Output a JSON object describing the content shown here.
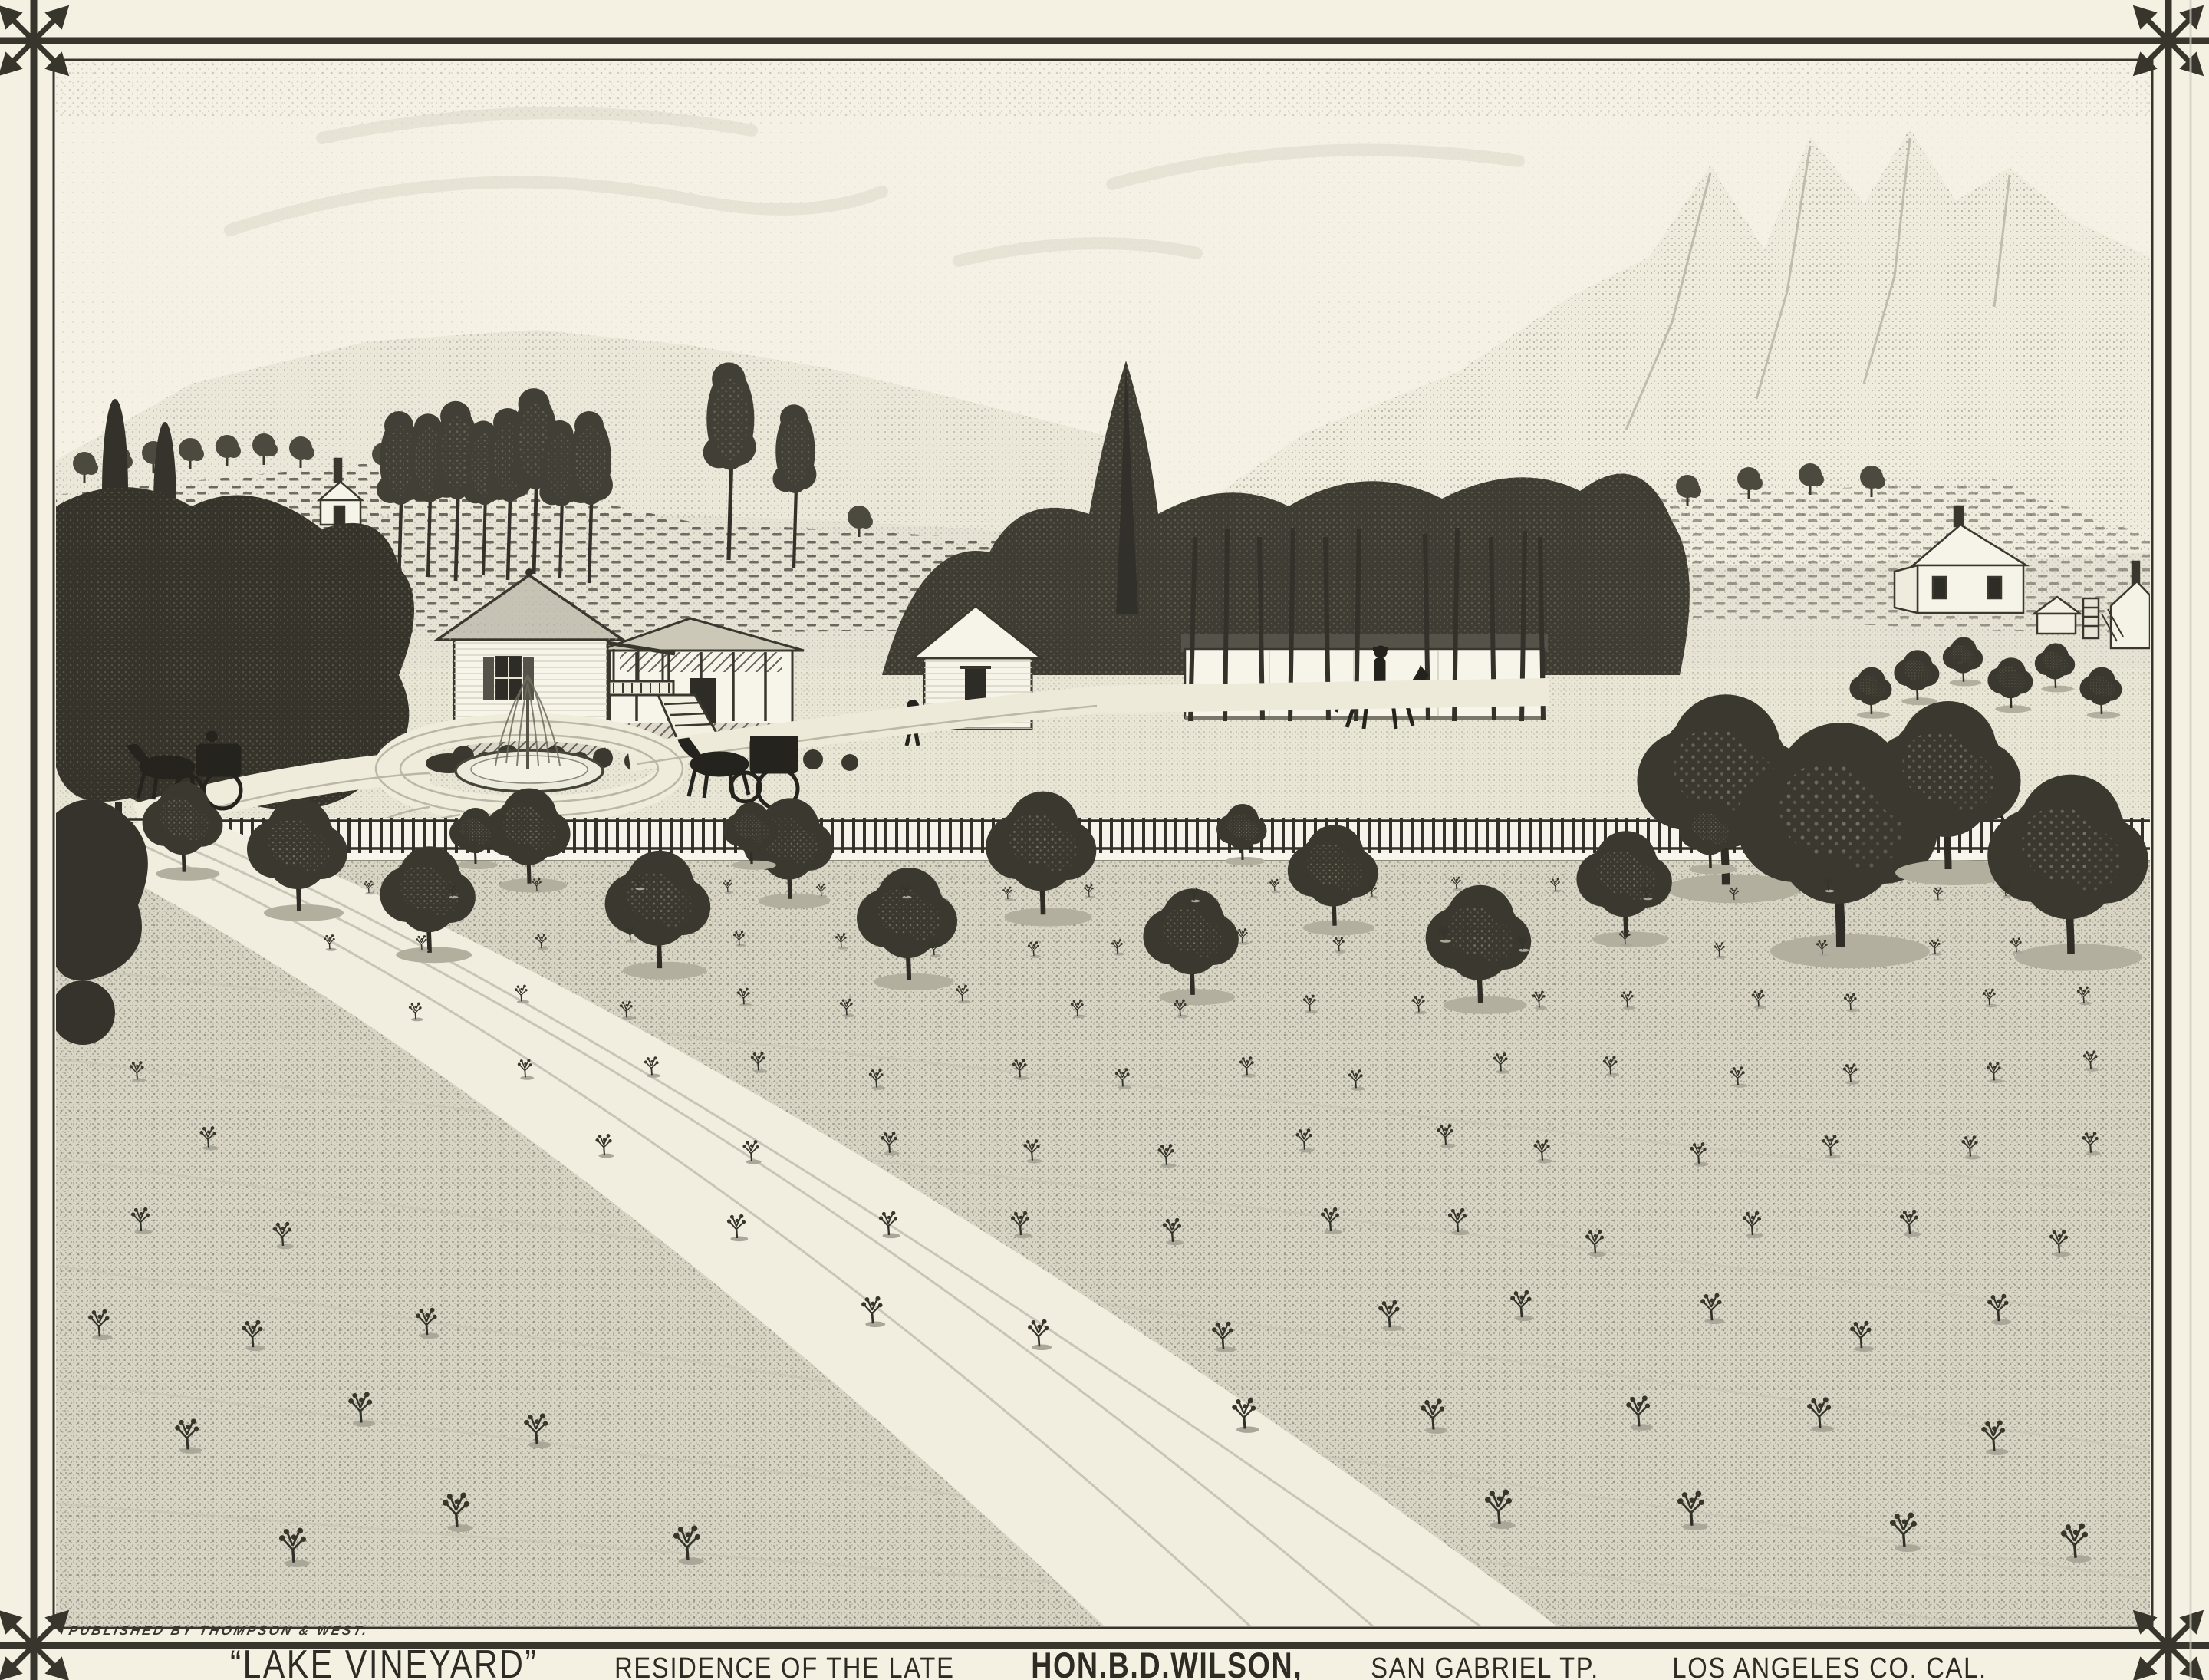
{
  "plate": {
    "publisher_credit": "PUBLISHED BY THOMPSON & WEST.",
    "caption": {
      "title": "“LAKE VINEYARD”",
      "subtitle": "RESIDENCE OF THE LATE",
      "owner": "HON.B.D.WILSON,",
      "township": "SAN GABRIEL TP.",
      "county": "LOS ANGELES CO. CAL."
    }
  },
  "colors": {
    "paper": "#f4f0e2",
    "ink": "#38352c",
    "foliage": "#3b392f",
    "field": "#d8d5c5",
    "lawn": "#e9e6d6",
    "wall": "#f7f4ea"
  }
}
